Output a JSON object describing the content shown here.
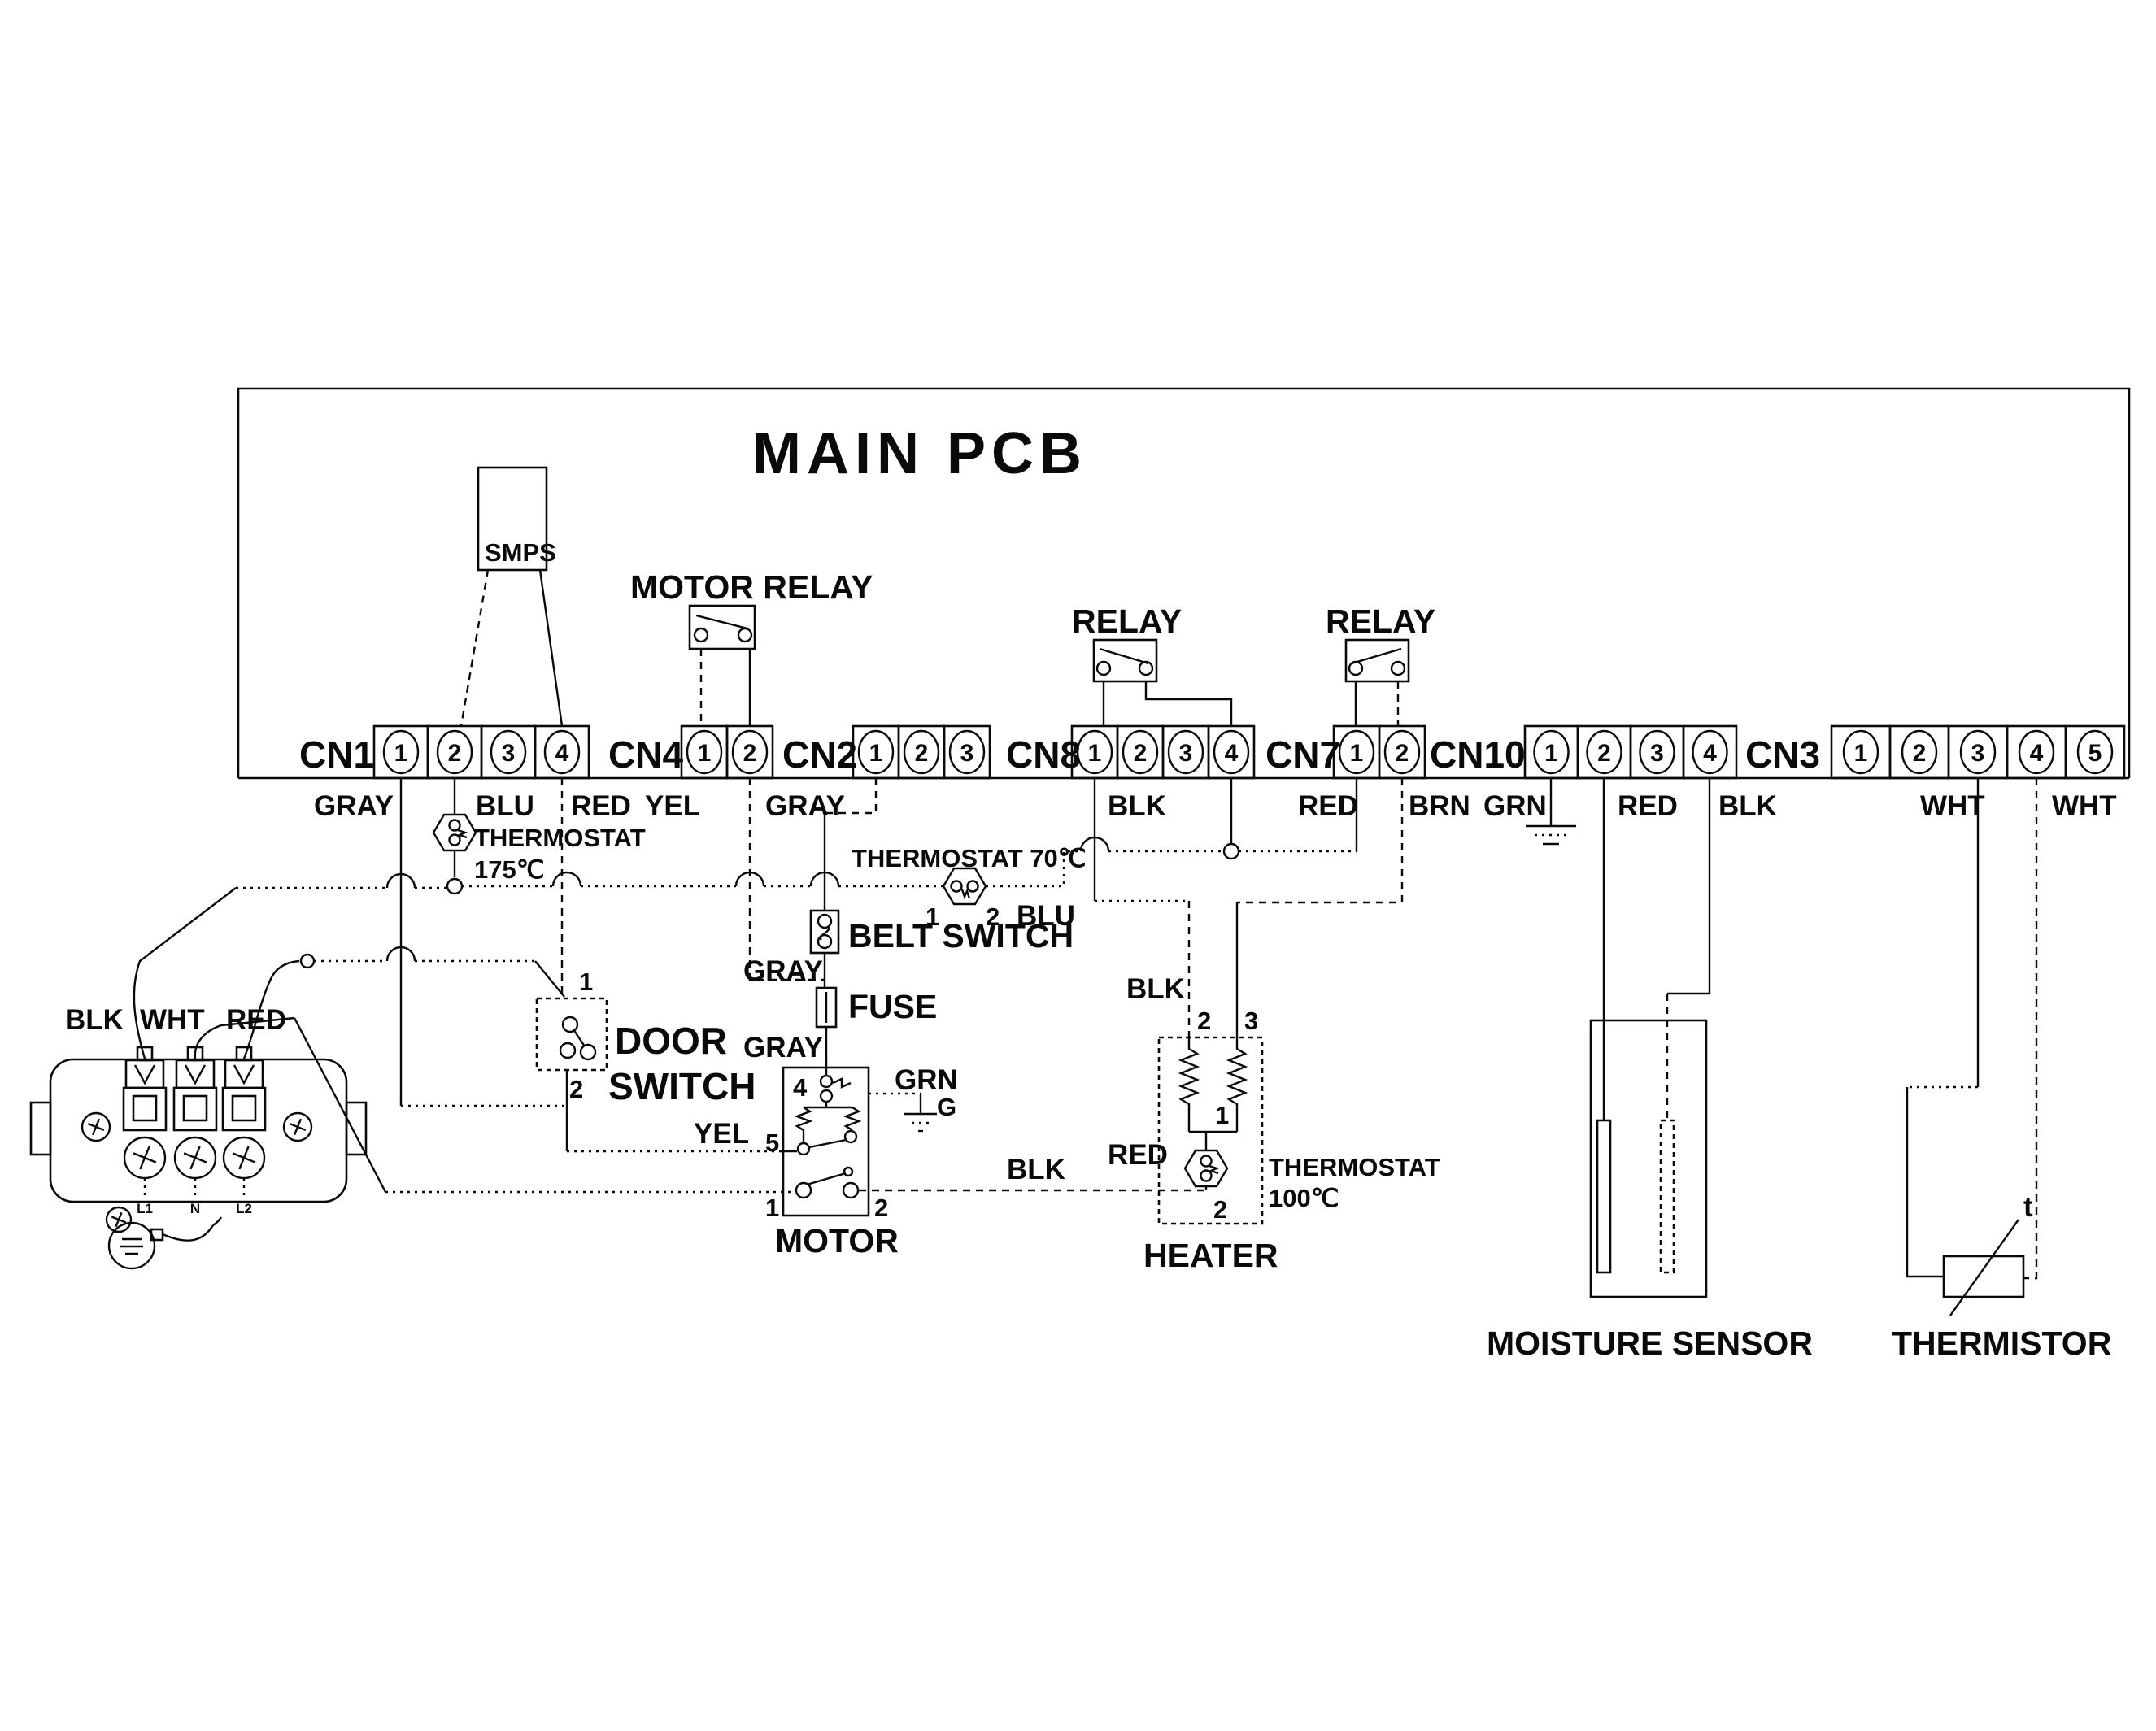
{
  "title": "MAIN PCB",
  "connectors": [
    {
      "name": "CN1",
      "pins": [
        "1",
        "2",
        "3",
        "4"
      ]
    },
    {
      "name": "CN4",
      "pins": [
        "1",
        "2"
      ]
    },
    {
      "name": "CN2",
      "pins": [
        "1",
        "2",
        "3"
      ]
    },
    {
      "name": "CN8",
      "pins": [
        "1",
        "2",
        "3",
        "4"
      ]
    },
    {
      "name": "CN7",
      "pins": [
        "1",
        "2"
      ]
    },
    {
      "name": "CN10",
      "pins": [
        "1",
        "2",
        "3",
        "4"
      ]
    },
    {
      "name": "CN3",
      "pins": [
        "1",
        "2",
        "3",
        "4",
        "5"
      ]
    }
  ],
  "labels": {
    "smps": "SMPS",
    "motor_relay": "MOTOR RELAY",
    "relay_left": "RELAY",
    "relay_right": "RELAY",
    "gray_cn1": "GRAY",
    "blu_cn1": "BLU",
    "red_cn1": "RED",
    "yel_cn4": "YEL",
    "gray_cn2": "GRAY",
    "blk_cn8": "BLK",
    "red_cn7": "RED",
    "brn_cn7": "BRN",
    "grn_cn10": "GRN",
    "red_cn10": "RED",
    "blk_cn10": "BLK",
    "wht_cn3a": "WHT",
    "wht_cn3b": "WHT",
    "thermostat175_line1": "THERMOSTAT",
    "thermostat175_line2": "175℃",
    "thermostat70": "THERMOSTAT 70℃",
    "t70_pin1": "1",
    "t70_pin2": "2",
    "blu_t70": "BLU",
    "belt_switch": "BELT SWITCH",
    "gray_belt": "GRAY",
    "fuse": "FUSE",
    "gray_fuse": "GRAY",
    "door_pin1": "1",
    "door_pin2": "2",
    "door_line1": "DOOR",
    "door_line2": "SWITCH",
    "yel_motor": "YEL",
    "grn_motor": "GRN",
    "g_motor": "G",
    "motor": "MOTOR",
    "motor_pin4": "4",
    "motor_pin5": "5",
    "motor_pin1": "1",
    "motor_pin2": "2",
    "blk_motor": "BLK",
    "blk_heater": "BLK",
    "red_heater": "RED",
    "heater": "HEATER",
    "heater_pin2": "2",
    "heater_pin3": "3",
    "heater_pin1": "1",
    "heater_pin2b": "2",
    "thermostat100_line1": "THERMOSTAT",
    "thermostat100_line2": "100℃",
    "moisture_sensor": "MOISTURE SENSOR",
    "thermistor": "THERMISTOR",
    "t_symbol": "t",
    "blk_cord": "BLK",
    "wht_cord": "WHT",
    "red_cord": "RED",
    "term_l1": "L1",
    "term_n": "N",
    "term_l2": "L2"
  },
  "components": {
    "smps": {
      "name": "SMPS"
    },
    "motor_relay": {
      "name": "MOTOR RELAY",
      "connects": "CN4"
    },
    "relay_heater_1": {
      "name": "RELAY",
      "connects": "CN8"
    },
    "relay_heater_2": {
      "name": "RELAY",
      "connects": "CN7"
    },
    "thermostat_175": {
      "name": "THERMOSTAT 175℃"
    },
    "thermostat_70": {
      "name": "THERMOSTAT 70℃",
      "pins": [
        "1",
        "2"
      ],
      "wire": "BLU"
    },
    "thermostat_100": {
      "name": "THERMOSTAT 100℃"
    },
    "belt_switch": {
      "name": "BELT SWITCH"
    },
    "door_switch": {
      "name": "DOOR SWITCH",
      "pins": [
        "1",
        "2"
      ]
    },
    "fuse": {
      "name": "FUSE"
    },
    "motor": {
      "name": "MOTOR",
      "pins": [
        "1",
        "2",
        "4",
        "5"
      ]
    },
    "heater": {
      "name": "HEATER",
      "pins": [
        "1",
        "2",
        "3",
        "2"
      ]
    },
    "moisture_sensor": {
      "name": "MOISTURE SENSOR"
    },
    "thermistor": {
      "name": "THERMISTOR",
      "symbol": "t"
    },
    "terminal_block": {
      "terminals": [
        "L1",
        "N",
        "L2"
      ],
      "wires": [
        "BLK",
        "WHT",
        "RED"
      ]
    }
  }
}
